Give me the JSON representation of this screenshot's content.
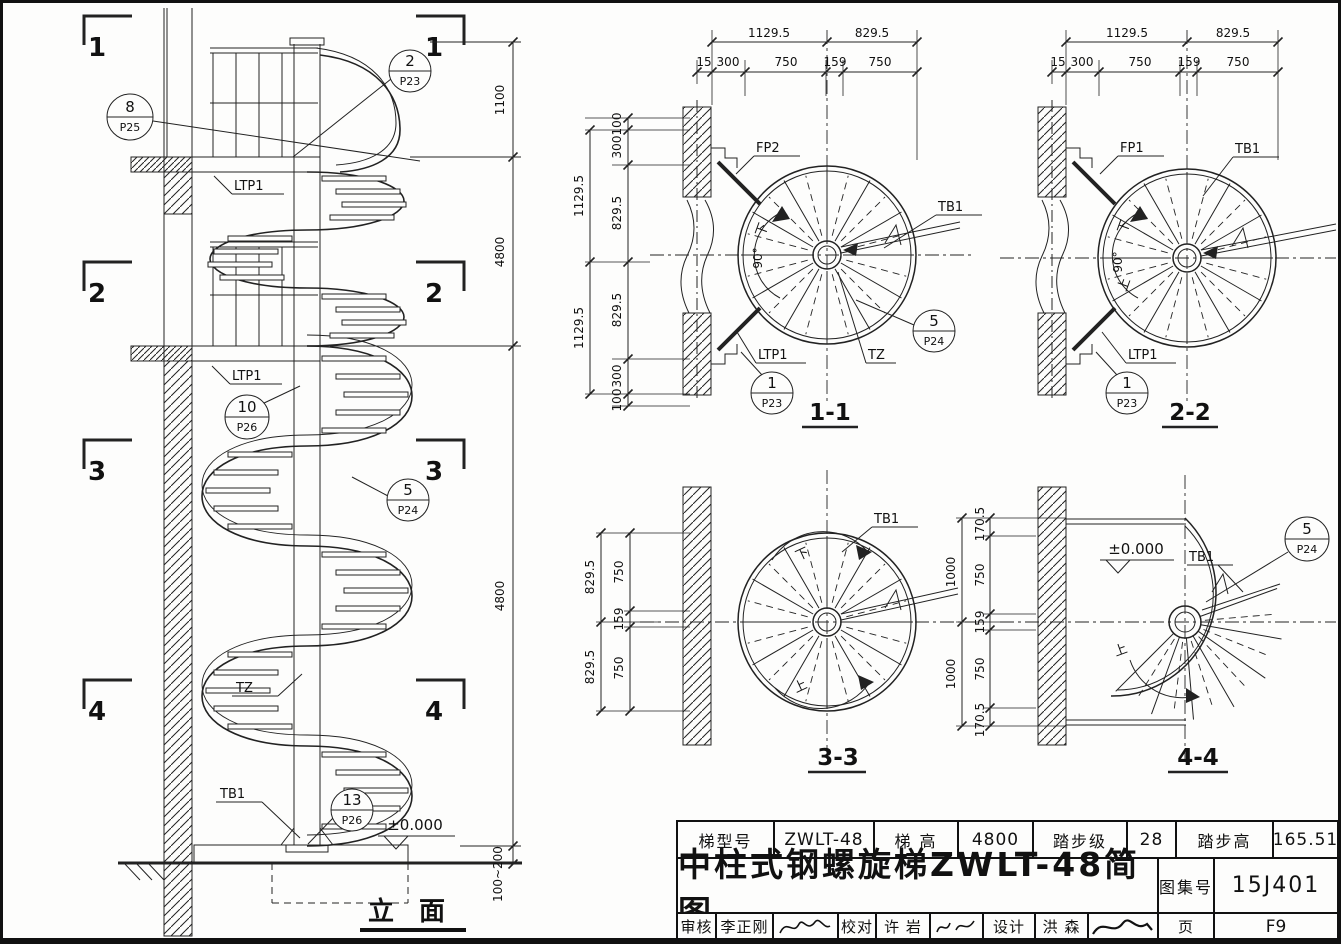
{
  "elevation": {
    "title": "立 面",
    "marks": {
      "m1": "1",
      "m2": "2",
      "m3": "3",
      "m4": "4"
    },
    "callouts": {
      "c8": {
        "num": "8",
        "ref": "P25"
      },
      "c2": {
        "num": "2",
        "ref": "P23"
      },
      "c10": {
        "num": "10",
        "ref": "P26"
      },
      "c5": {
        "num": "5",
        "ref": "P24"
      },
      "c13": {
        "num": "13",
        "ref": "P26"
      }
    },
    "labels": {
      "ltp1_top": "LTP1",
      "ltp1_mid": "LTP1",
      "tz": "TZ",
      "tb1": "TB1",
      "level": "±0.000"
    },
    "dims": {
      "rail": "1100",
      "upper": "4800",
      "lower": "4800",
      "base": "100~200"
    }
  },
  "sections": {
    "s11": {
      "title": "1-1",
      "top1": [
        "1129.5",
        "829.5"
      ],
      "top2": [
        "15",
        "300",
        "750",
        "159",
        "750"
      ],
      "left_outer": [
        "1129.5",
        "1129.5"
      ],
      "left_inner": [
        "100",
        "300",
        "829.5",
        "829.5",
        "300",
        "100"
      ],
      "labels": {
        "fp": "FP2",
        "tb1": "TB1",
        "tz": "TZ",
        "ltp1": "LTP1",
        "down": "下",
        "angle": "90°"
      },
      "callouts": {
        "c1": {
          "num": "1",
          "ref": "P23"
        },
        "c5": {
          "num": "5",
          "ref": "P24"
        }
      }
    },
    "s22": {
      "title": "2-2",
      "top1": [
        "1129.5",
        "829.5"
      ],
      "top2": [
        "15",
        "300",
        "750",
        "159",
        "750"
      ],
      "labels": {
        "fp": "FP1",
        "tb1": "TB1",
        "ltp1": "LTP1",
        "down": "下",
        "up": "上",
        "angle": "90°"
      },
      "callouts": {
        "c1": {
          "num": "1",
          "ref": "P23"
        }
      }
    },
    "s33": {
      "title": "3-3",
      "left_outer": [
        "829.5",
        "829.5"
      ],
      "left_inner": [
        "750",
        "159",
        "750"
      ],
      "labels": {
        "tb1": "TB1",
        "down": "下",
        "up": "上"
      }
    },
    "s44": {
      "title": "4-4",
      "left_outer": [
        "1000",
        "1000"
      ],
      "left_inner": [
        "170.5",
        "750",
        "159",
        "750",
        "170.5"
      ],
      "labels": {
        "tb1": "TB1",
        "up": "上",
        "level": "±0.000"
      },
      "callouts": {
        "c5": {
          "num": "5",
          "ref": "P24"
        }
      }
    }
  },
  "title_block": {
    "spec": [
      {
        "label": "梯型号",
        "value": "ZWLT-48"
      },
      {
        "label": "梯  高",
        "value": "4800"
      },
      {
        "label": "踏步级",
        "value": "28"
      },
      {
        "label": "踏步高",
        "value": "165.51"
      }
    ],
    "title": "中柱式钢螺旋梯ZWLT-48简图",
    "atlas_label": "图集号",
    "atlas_value": "15J401",
    "page_label": "页",
    "page_value": "F9",
    "approvers": [
      {
        "label": "审核",
        "name": "李正刚"
      },
      {
        "label": "校对",
        "name": "许 岩"
      },
      {
        "label": "设计",
        "name": "洪 森"
      }
    ]
  }
}
